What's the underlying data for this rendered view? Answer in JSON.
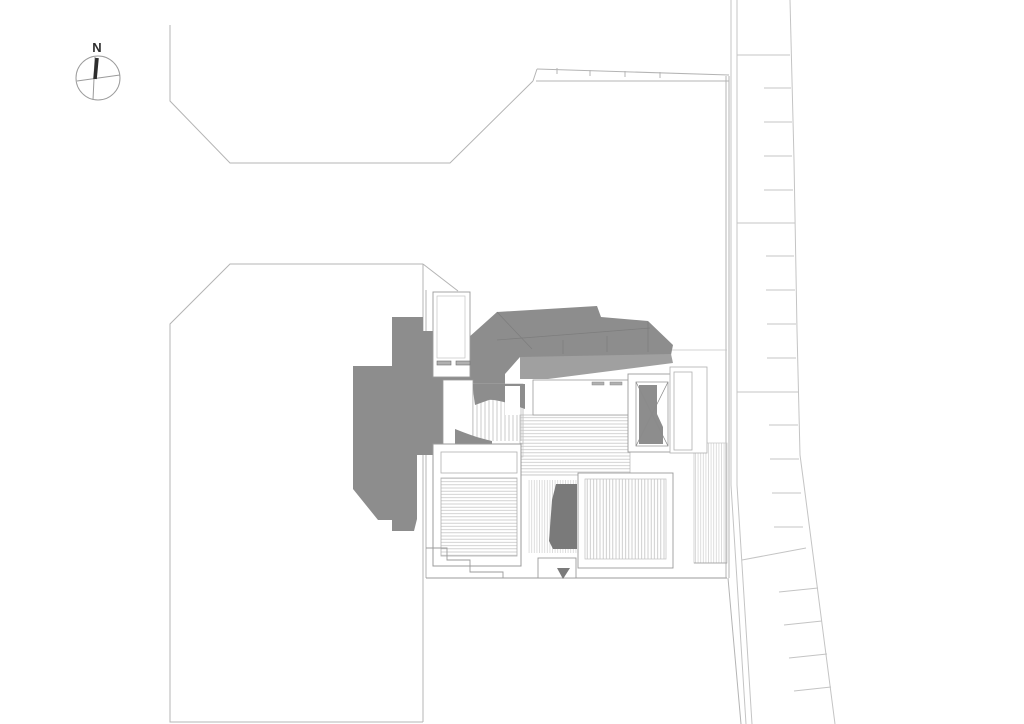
{
  "drawing": {
    "kind": "architectural site plan",
    "compass": {
      "label": "N"
    },
    "colors": {
      "background": "#ffffff",
      "roof_gray": "#8d8d8d",
      "eave_gray": "#a0a0a0",
      "dark_gray": "#7a7a7a",
      "hatch_line": "#c6c6c6",
      "boundary_line": "#b4b4b4",
      "detail_line": "#9b9b9b",
      "ink": "#2e2e2e"
    },
    "road": {
      "full_dividers": 4,
      "short_bay_ticks": 16
    }
  }
}
